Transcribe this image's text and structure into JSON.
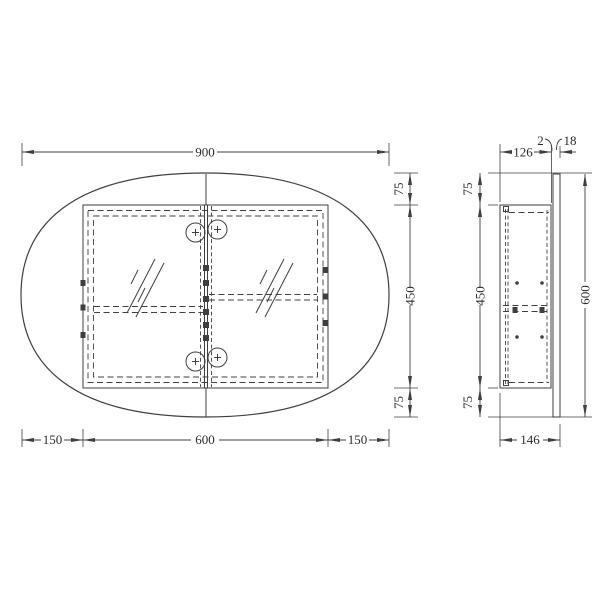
{
  "drawing": {
    "type": "technical-orthographic-drawing",
    "subject": "oval-mirror-cabinet",
    "background": "#ffffff",
    "line_color": "#3f3f3f",
    "text_color": "#2b2b2b",
    "front_view": {
      "top_width": "900",
      "right_top": "75",
      "right_middle": "450",
      "right_bottom": "75",
      "bottom_left": "150",
      "bottom_center": "600",
      "bottom_right": "150"
    },
    "side_view": {
      "top_depth": "126",
      "front_gap": "2",
      "mirror_thickness": "18",
      "left_top": "75",
      "left_middle": "450",
      "left_bottom": "75",
      "total_height": "600",
      "bottom_depth": "146"
    }
  }
}
